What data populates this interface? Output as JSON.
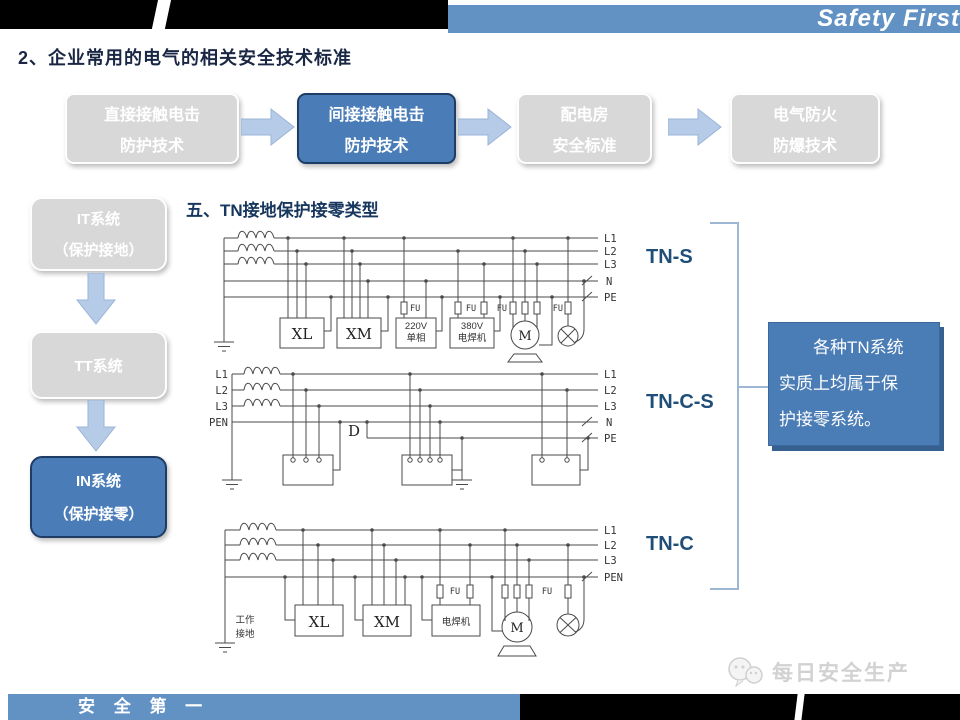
{
  "header": {
    "brand": "Safety First",
    "title": "2、企业常用的电气的相关安全技术标准"
  },
  "flow": {
    "items": [
      {
        "line1": "直接接触电击",
        "line2": "防护技术",
        "active": false
      },
      {
        "line1": "间接接触电击",
        "line2": "防护技术",
        "active": true
      },
      {
        "line1": "配电房",
        "line2": "安全标准",
        "active": false
      },
      {
        "line1": "电气防火",
        "line2": "防爆技术",
        "active": false
      }
    ]
  },
  "sidebar": {
    "items": [
      {
        "line1": "IT系统",
        "line2": "（保护接地）",
        "active": false
      },
      {
        "line1": "TT系统",
        "line2": "",
        "active": false
      },
      {
        "line1": "IN系统",
        "line2": "（保护接零）",
        "active": true
      }
    ]
  },
  "section": {
    "heading": "五、TN接地保护接零类型"
  },
  "tn_labels": {
    "tns": "TN-S",
    "tncs": "TN-C-S",
    "tnc": "TN-C"
  },
  "diag": {
    "l1": "L1",
    "l2": "L2",
    "l3": "L3",
    "n": "N",
    "pe": "PE",
    "pen": "PEN",
    "xl": "XL",
    "xm": "XM",
    "m": "M",
    "fu": "FU",
    "d": "D",
    "v220": "220V",
    "single_phase": "单相",
    "v380": "380V",
    "welder": "电焊机",
    "work1": "工作",
    "work2": "接地"
  },
  "note": {
    "lines": [
      "各种TN系统",
      "实质上均属于保",
      "护接零系统。"
    ]
  },
  "footer": {
    "slogan": "安 全 第 一",
    "watermark": "每日安全生产"
  },
  "colors": {
    "accent_blue": "#4a7db8",
    "bar_blue": "#6292c4",
    "box_gray": "#d8d8d8",
    "arrow_blue": "#b5cbe7",
    "navy_text": "#1f4e79",
    "wire": "#4a4a4a"
  }
}
